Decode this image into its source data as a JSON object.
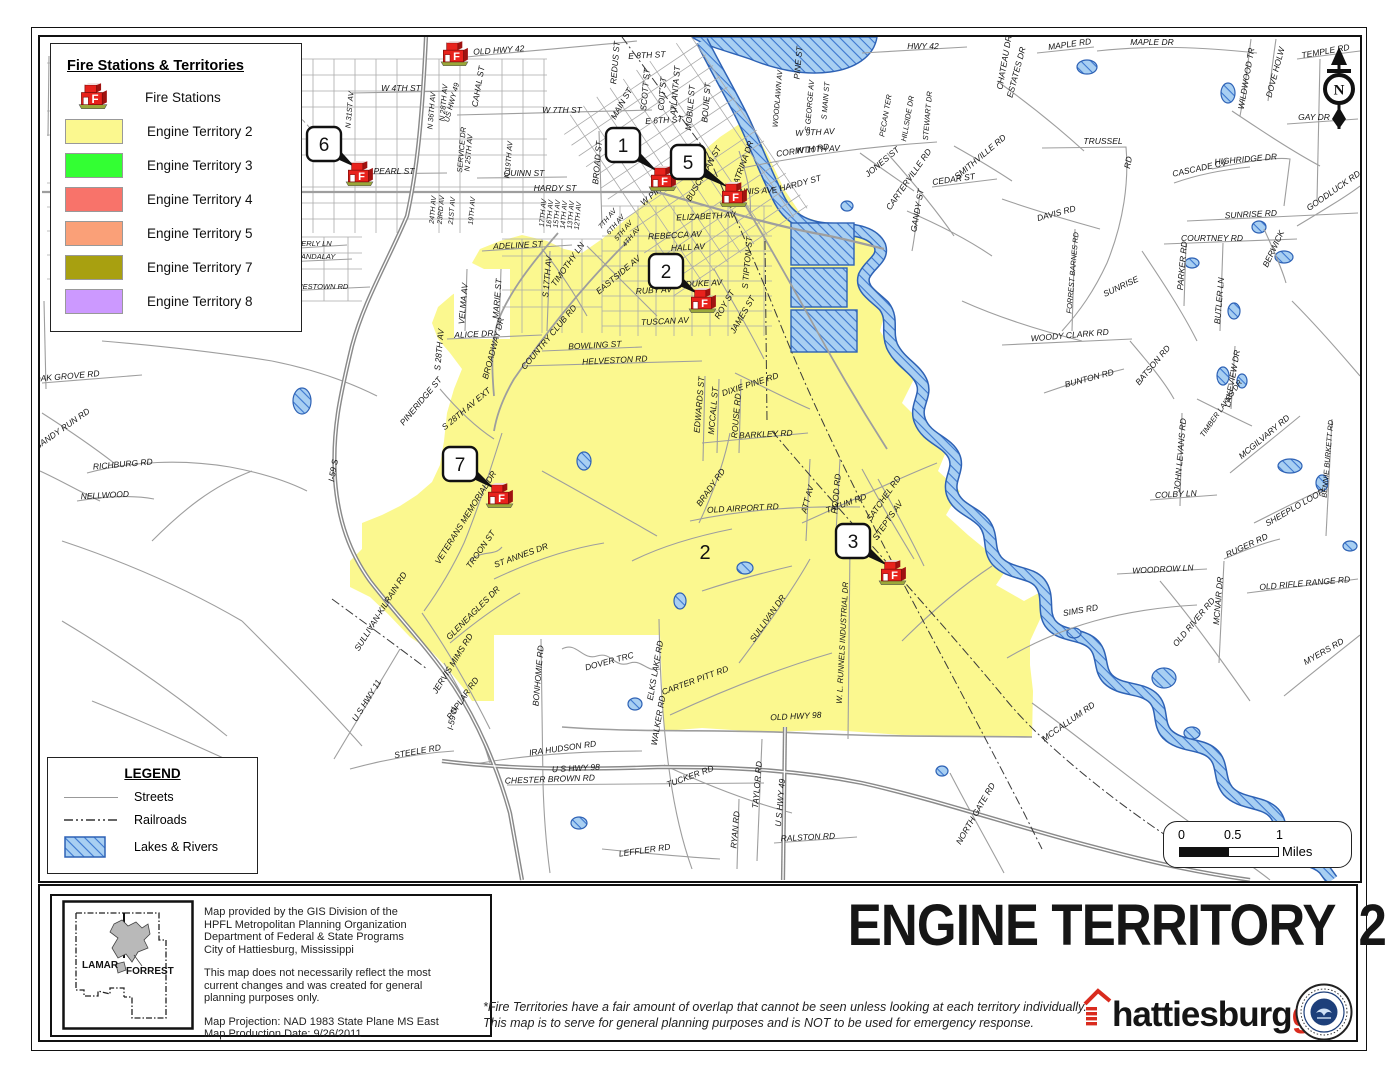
{
  "page": {
    "title_main": "ENGINE TERRITORY",
    "title_number": "2",
    "disclaimer_lines": [
      "*Fire Territories have a fair amount of overlap that cannot be seen unless looking at each territory individually.",
      "This map is to serve for general planning purposes and is NOT to be used for emergency response."
    ]
  },
  "legend_main": {
    "title": "Fire Stations & Territories",
    "fire_stations_label": "Fire Stations",
    "territories": [
      {
        "label": "Engine Territory 2",
        "color": "#FBF88F"
      },
      {
        "label": "Engine Territory 3",
        "color": "#33FF33"
      },
      {
        "label": "Engine Territory 4",
        "color": "#F8736A"
      },
      {
        "label": "Engine Territory 5",
        "color": "#FAA078"
      },
      {
        "label": "Engine Territory 7",
        "color": "#A8A010"
      },
      {
        "label": "Engine Territory 8",
        "color": "#CC99FF"
      }
    ]
  },
  "legend_sub": {
    "title": "LEGEND",
    "streets": "Streets",
    "railroads": "Railroads",
    "lakes": "Lakes & Rivers"
  },
  "scalebar": {
    "t0": "0",
    "t05": "0.5",
    "t1": "1",
    "unit": "Miles"
  },
  "north_arrow": {
    "letter": "N"
  },
  "credits": {
    "p1": [
      "Map provided by the GIS Division of the",
      "HPFL Metropolitan Planning Organization",
      "Department of Federal & State Programs",
      "City of Hattiesburg, Mississippi"
    ],
    "p2": [
      "This map does not necessarily reflect the most",
      "current changes and was created for general",
      "planning purposes only."
    ],
    "p3": [
      "Map Projection: NAD 1983 State Plane MS East",
      "Map Production Date: 9/26/2011"
    ]
  },
  "inset": {
    "left_county": "LAMAR",
    "right_county": "FORREST"
  },
  "logo": {
    "black": "hattiesburg",
    "red": "gis"
  },
  "map": {
    "territory_fill": "#FBF88F",
    "water_fill": "#A8CFF2",
    "water_line": "#2E62B5",
    "territory_number": {
      "text": "2",
      "x": 703,
      "y": 558,
      "size": 20
    },
    "stations": [
      {
        "label": "1",
        "box": [
          604,
          127
        ],
        "icon": [
          660,
          175
        ]
      },
      {
        "label": "5",
        "box": [
          669,
          144
        ],
        "icon": [
          731,
          191
        ]
      },
      {
        "label": "2",
        "box": [
          647,
          253
        ],
        "icon": [
          700,
          297
        ]
      },
      {
        "label": "6",
        "box": [
          305,
          126
        ],
        "icon": [
          357,
          170
        ]
      },
      {
        "label": "7",
        "box": [
          441,
          446
        ],
        "icon": [
          497,
          492
        ]
      },
      {
        "label": "3",
        "box": [
          834,
          523
        ],
        "icon": [
          890,
          569
        ]
      },
      {
        "label": "",
        "icon": [
          452,
          50
        ]
      }
    ],
    "labels": [
      [
        "OLD HWY 42",
        497,
        52,
        -4
      ],
      [
        "HWY 42",
        921,
        48,
        0
      ],
      [
        "MAPLE RD",
        1068,
        46,
        -8
      ],
      [
        "MAPLE DR",
        1150,
        44,
        0
      ],
      [
        "WILDWOOD TR",
        1247,
        78,
        -80
      ],
      [
        "DOVE HOLW",
        1276,
        72,
        -75
      ],
      [
        "TEMPLE RD",
        1324,
        53,
        -10
      ],
      [
        "GAY DR",
        1312,
        119,
        0
      ],
      [
        "TRUSSEL",
        1101,
        143,
        0
      ],
      [
        "RD",
        1129,
        162,
        -80
      ],
      [
        "CASCADE CV",
        1198,
        170,
        -12
      ],
      [
        "HIGHRIDGE DR",
        1244,
        161,
        -5
      ],
      [
        "GOODLUCK RD",
        1333,
        192,
        -35
      ],
      [
        "SUNRISE RD",
        1249,
        216,
        -3
      ],
      [
        "COURTNEY RD",
        1210,
        240,
        0
      ],
      [
        "BERWICK",
        1274,
        249,
        -65
      ],
      [
        "PARKER RD",
        1183,
        265,
        -85
      ],
      [
        "BUTLER LN",
        1220,
        300,
        -85
      ],
      [
        "DAVIS RD",
        1055,
        215,
        -15
      ],
      [
        "FORREST BARNES RD",
        1073,
        272,
        -85,
        7.5
      ],
      [
        "SUNRISE",
        1120,
        288,
        -25
      ],
      [
        "ESTATES DR",
        1017,
        72,
        -75
      ],
      [
        "CHATEAU DR",
        1005,
        62,
        -80
      ],
      [
        "PINE ST",
        799,
        62,
        -85
      ],
      [
        "S GEORGE AV",
        810,
        105,
        -85,
        7.5
      ],
      [
        "S MAIN ST",
        826,
        100,
        -85,
        7.5
      ],
      [
        "WOODLAWN AV",
        778,
        98,
        -85,
        7.5
      ],
      [
        "PECAN TER",
        886,
        115,
        -80,
        7.5
      ],
      [
        "HILLSIDE DR",
        908,
        118,
        -80,
        7.5
      ],
      [
        "STEWART DR",
        928,
        115,
        -85,
        7.5
      ],
      [
        "W 9TH AV",
        813,
        134,
        -3
      ],
      [
        "W 10TH AV",
        816,
        151,
        -3
      ],
      [
        "CORINTH RD",
        801,
        152,
        -8
      ],
      [
        "KATRINA DR",
        743,
        165,
        -70
      ],
      [
        "JONES ST",
        882,
        163,
        -40
      ],
      [
        "CARTERVILLE RD",
        909,
        180,
        -55
      ],
      [
        "CEDAR ST",
        952,
        181,
        -8
      ],
      [
        "GANDY ST",
        918,
        210,
        -80
      ],
      [
        "SMITHVILLE RD",
        980,
        158,
        -40
      ],
      [
        "E HARDY ST",
        795,
        186,
        -15
      ],
      [
        "W 7TH ST",
        560,
        112,
        0
      ],
      [
        "E 6TH ST",
        662,
        122,
        -3
      ],
      [
        "E 8TH ST",
        645,
        57,
        -3
      ],
      [
        "REDUS ST",
        616,
        62,
        -85
      ],
      [
        "MAIN ST",
        622,
        104,
        -60
      ],
      [
        "SCOTT ST",
        646,
        89,
        -85
      ],
      [
        "COIT ST",
        663,
        93,
        -85
      ],
      [
        "ATLANTA ST",
        676,
        90,
        -85
      ],
      [
        "MOBILE ST",
        691,
        107,
        -85
      ],
      [
        "BOUIE ST",
        707,
        102,
        -85
      ],
      [
        "QUINN ST",
        522,
        175,
        0
      ],
      [
        "HARDY ST",
        553,
        190,
        0
      ],
      [
        "BROAD ST",
        598,
        162,
        -85
      ],
      [
        "W PINE ST",
        658,
        191,
        -40
      ],
      [
        "BUSCHMAN ST",
        704,
        174,
        -60
      ],
      [
        "DENNIS AV",
        748,
        193,
        -3
      ],
      [
        "ELIZABETH AV",
        704,
        218,
        -3
      ],
      [
        "REBECCA AV",
        673,
        237,
        -3
      ],
      [
        "HALL AV",
        686,
        249,
        -3
      ],
      [
        "S TIPTON ST",
        748,
        262,
        -85
      ],
      [
        "PEARL ST",
        392,
        173,
        0
      ],
      [
        "CAHAL ST",
        479,
        86,
        -80
      ],
      [
        "N 36TH AV",
        432,
        110,
        -85,
        7.5
      ],
      [
        "N 28TH AV",
        444,
        102,
        -85,
        7.5
      ],
      [
        "US HWY 49",
        452,
        102,
        -75,
        7.5
      ],
      [
        "SERVICE DR",
        462,
        149,
        -85,
        7.5
      ],
      [
        "N 25TH AV",
        469,
        152,
        -85,
        7.5
      ],
      [
        "N 19TH AV",
        509,
        159,
        -85,
        7.5
      ],
      [
        "W 4TH ST",
        399,
        90,
        0
      ],
      [
        "N 31ST AV",
        350,
        109,
        -85,
        7.5
      ],
      [
        "WESTOVER DR",
        297,
        135,
        -85
      ],
      [
        "W HILLS DR",
        257,
        62,
        -40
      ],
      [
        "RAILS TO TRAILS",
        272,
        84,
        -40,
        7.5
      ],
      [
        "LAMAR AV",
        289,
        250,
        -85
      ],
      [
        "BEVERLY LN",
        307,
        245,
        0,
        7.5
      ],
      [
        "MANDALAY",
        313,
        258,
        0,
        7.5
      ],
      [
        "JAMESTOWN RD",
        316,
        288,
        0,
        7.5
      ],
      [
        "ADELINE ST",
        516,
        247,
        -3
      ],
      [
        "TIMOTHY LN",
        568,
        265,
        -55
      ],
      [
        "S 17TH AV",
        548,
        276,
        -85
      ],
      [
        "EASTSIDE AV",
        618,
        276,
        -40
      ],
      [
        "VELMA AV",
        464,
        303,
        -85
      ],
      [
        "MARIE ST",
        498,
        298,
        -85
      ],
      [
        "RUBY AV",
        652,
        292,
        -3
      ],
      [
        "DUKE AV",
        702,
        285,
        -3
      ],
      [
        "ROY ST",
        725,
        305,
        -60
      ],
      [
        "JAMES ST",
        743,
        315,
        -60
      ],
      [
        "TUSCAN AV",
        663,
        323,
        -3
      ],
      [
        "ALICE DR",
        472,
        336,
        -3
      ],
      [
        "BROADWAY DR",
        494,
        348,
        -75
      ],
      [
        "COUNTRY CLUB RD",
        549,
        338,
        -50
      ],
      [
        "BOWLING ST",
        593,
        347,
        -3
      ],
      [
        "HELVESTON RD",
        613,
        362,
        -3
      ],
      [
        "S 28TH AV",
        440,
        349,
        -85
      ],
      [
        "S 28TH AV EXT",
        466,
        410,
        -40
      ],
      [
        "PINERIDGE ST",
        421,
        402,
        -50
      ],
      [
        "EDWARDS ST",
        700,
        404,
        -85
      ],
      [
        "MCCALL ST",
        714,
        410,
        -85
      ],
      [
        "ROUSE RD",
        737,
        415,
        -85
      ],
      [
        "DIXIE PINE RD",
        749,
        386,
        -18
      ],
      [
        "BARKLEY RD",
        764,
        436,
        -3
      ],
      [
        "24TH AV",
        433,
        209,
        -85,
        7
      ],
      [
        "23RD AV",
        441,
        209,
        -85,
        7
      ],
      [
        "21ST AV",
        452,
        210,
        -85,
        7
      ],
      [
        "19TH AV",
        472,
        210,
        -85,
        7
      ],
      [
        "17TH AV",
        543,
        212,
        -85,
        7
      ],
      [
        "16TH AV",
        550,
        213,
        -85,
        7
      ],
      [
        "15TH AV",
        557,
        213,
        -85,
        7
      ],
      [
        "14TH AV",
        564,
        214,
        -85,
        7
      ],
      [
        "13TH AV",
        571,
        214,
        -85,
        7
      ],
      [
        "12TH AV",
        578,
        215,
        -85,
        7
      ],
      [
        "7TH AV",
        607,
        219,
        -50,
        7
      ],
      [
        "6TH AV",
        615,
        225,
        -50,
        7
      ],
      [
        "5TH AV",
        623,
        231,
        -50,
        7
      ],
      [
        "4TH AV",
        631,
        237,
        -50,
        7
      ],
      [
        "VETERANS MEMORIAL DR",
        466,
        518,
        -58
      ],
      [
        "TROON ST",
        481,
        550,
        -55
      ],
      [
        "ST ANNES DR",
        520,
        557,
        -20
      ],
      [
        "GLENEAGLES DR",
        473,
        614,
        -45
      ],
      [
        "SULLIVAN-KILRAIN RD",
        381,
        612,
        -58
      ],
      [
        "U S HWY 11",
        367,
        701,
        -58
      ],
      [
        "JERVIS MIMS RD",
        453,
        664,
        -58
      ],
      [
        "POPLAR RD",
        463,
        699,
        -55
      ],
      [
        "I-59 N",
        453,
        718,
        -80
      ],
      [
        "I-59 S",
        334,
        470,
        -80
      ],
      [
        "STEELE RD",
        416,
        753,
        -10
      ],
      [
        "IRA HUDSON RD",
        561,
        750,
        -8
      ],
      [
        "U S HWY 98",
        574,
        770,
        -3
      ],
      [
        "CHESTER BROWN RD",
        548,
        781,
        -2
      ],
      [
        "BONHOMIE RD",
        539,
        675,
        -85
      ],
      [
        "DOVER TRC",
        608,
        663,
        -15
      ],
      [
        "ELKS LAKE RD",
        656,
        670,
        -80
      ],
      [
        "WALKER RD",
        659,
        720,
        -80
      ],
      [
        "CARTER PITT RD",
        694,
        682,
        -20
      ],
      [
        "OLD HWY 98",
        794,
        718,
        -3
      ],
      [
        "TUCKER RD",
        689,
        778,
        -20
      ],
      [
        "TAYLOR RD",
        758,
        784,
        -85
      ],
      [
        "U S HWY 49",
        781,
        802,
        -85
      ],
      [
        "RYAN RD",
        736,
        829,
        -85
      ],
      [
        "RALSTON RD",
        806,
        839,
        -3
      ],
      [
        "LEFFLER RD",
        643,
        852,
        -8
      ],
      [
        "NELLWOOD",
        103,
        497,
        -3
      ],
      [
        "RICHBURG RD",
        121,
        466,
        -5
      ],
      [
        "SANDY RUN RD",
        62,
        430,
        -35
      ],
      [
        "OAK GROVE RD",
        65,
        378,
        -5
      ],
      [
        "HEGWOOD RD",
        12,
        332,
        -85
      ],
      [
        "JACKSON RD",
        16,
        90,
        -85
      ],
      [
        "BRADY RD",
        711,
        488,
        -55
      ],
      [
        "OLD AIRPORT RD",
        741,
        510,
        -3
      ],
      [
        "ATT AV",
        808,
        499,
        -75
      ],
      [
        "HOOD RD",
        837,
        493,
        -85
      ],
      [
        "TATUM RD",
        845,
        505,
        -20
      ],
      [
        "SATCHEL RD",
        884,
        499,
        -55
      ],
      [
        "STEPTS AV",
        888,
        521,
        -55
      ],
      [
        "SULLIVAN DR",
        768,
        619,
        -55
      ],
      [
        "W. L.  RUNNELS  INDUSTRIAL DR",
        843,
        642,
        -87,
        8
      ],
      [
        "SIMS RD",
        1079,
        612,
        -10
      ],
      [
        "MCCALLUM RD",
        1068,
        723,
        -35
      ],
      [
        "NORTH GATE RD",
        976,
        814,
        -60
      ],
      [
        "OLD RIVER RD",
        1194,
        623,
        -50
      ],
      [
        "MCNAIR DR",
        1219,
        600,
        -85
      ],
      [
        "OLD RIFLE RANGE RD",
        1303,
        585,
        -5
      ],
      [
        "MYERS RD",
        1323,
        653,
        -30
      ],
      [
        "WOODROW LN",
        1161,
        571,
        -3
      ],
      [
        "RUGER RD",
        1246,
        547,
        -25
      ],
      [
        "SHEEPLO LOOP",
        1294,
        509,
        -30
      ],
      [
        "COLBY LN",
        1174,
        496,
        -3
      ],
      [
        "JOHN LEVANS RD",
        1181,
        454,
        -85
      ],
      [
        "BENNIE BURKETT RD",
        1328,
        458,
        -85,
        7.5
      ],
      [
        "MCGILVARY RD",
        1264,
        438,
        -40
      ],
      [
        "TIMBER LAKES DR",
        1221,
        409,
        -55,
        7.5
      ],
      [
        "LAKEVIEW DR",
        1233,
        378,
        -80
      ],
      [
        "BATSON RD",
        1153,
        366,
        -50
      ],
      [
        "BUNTON RD",
        1088,
        380,
        -15
      ],
      [
        "WOODY CLARK RD",
        1068,
        337,
        -5
      ]
    ]
  }
}
